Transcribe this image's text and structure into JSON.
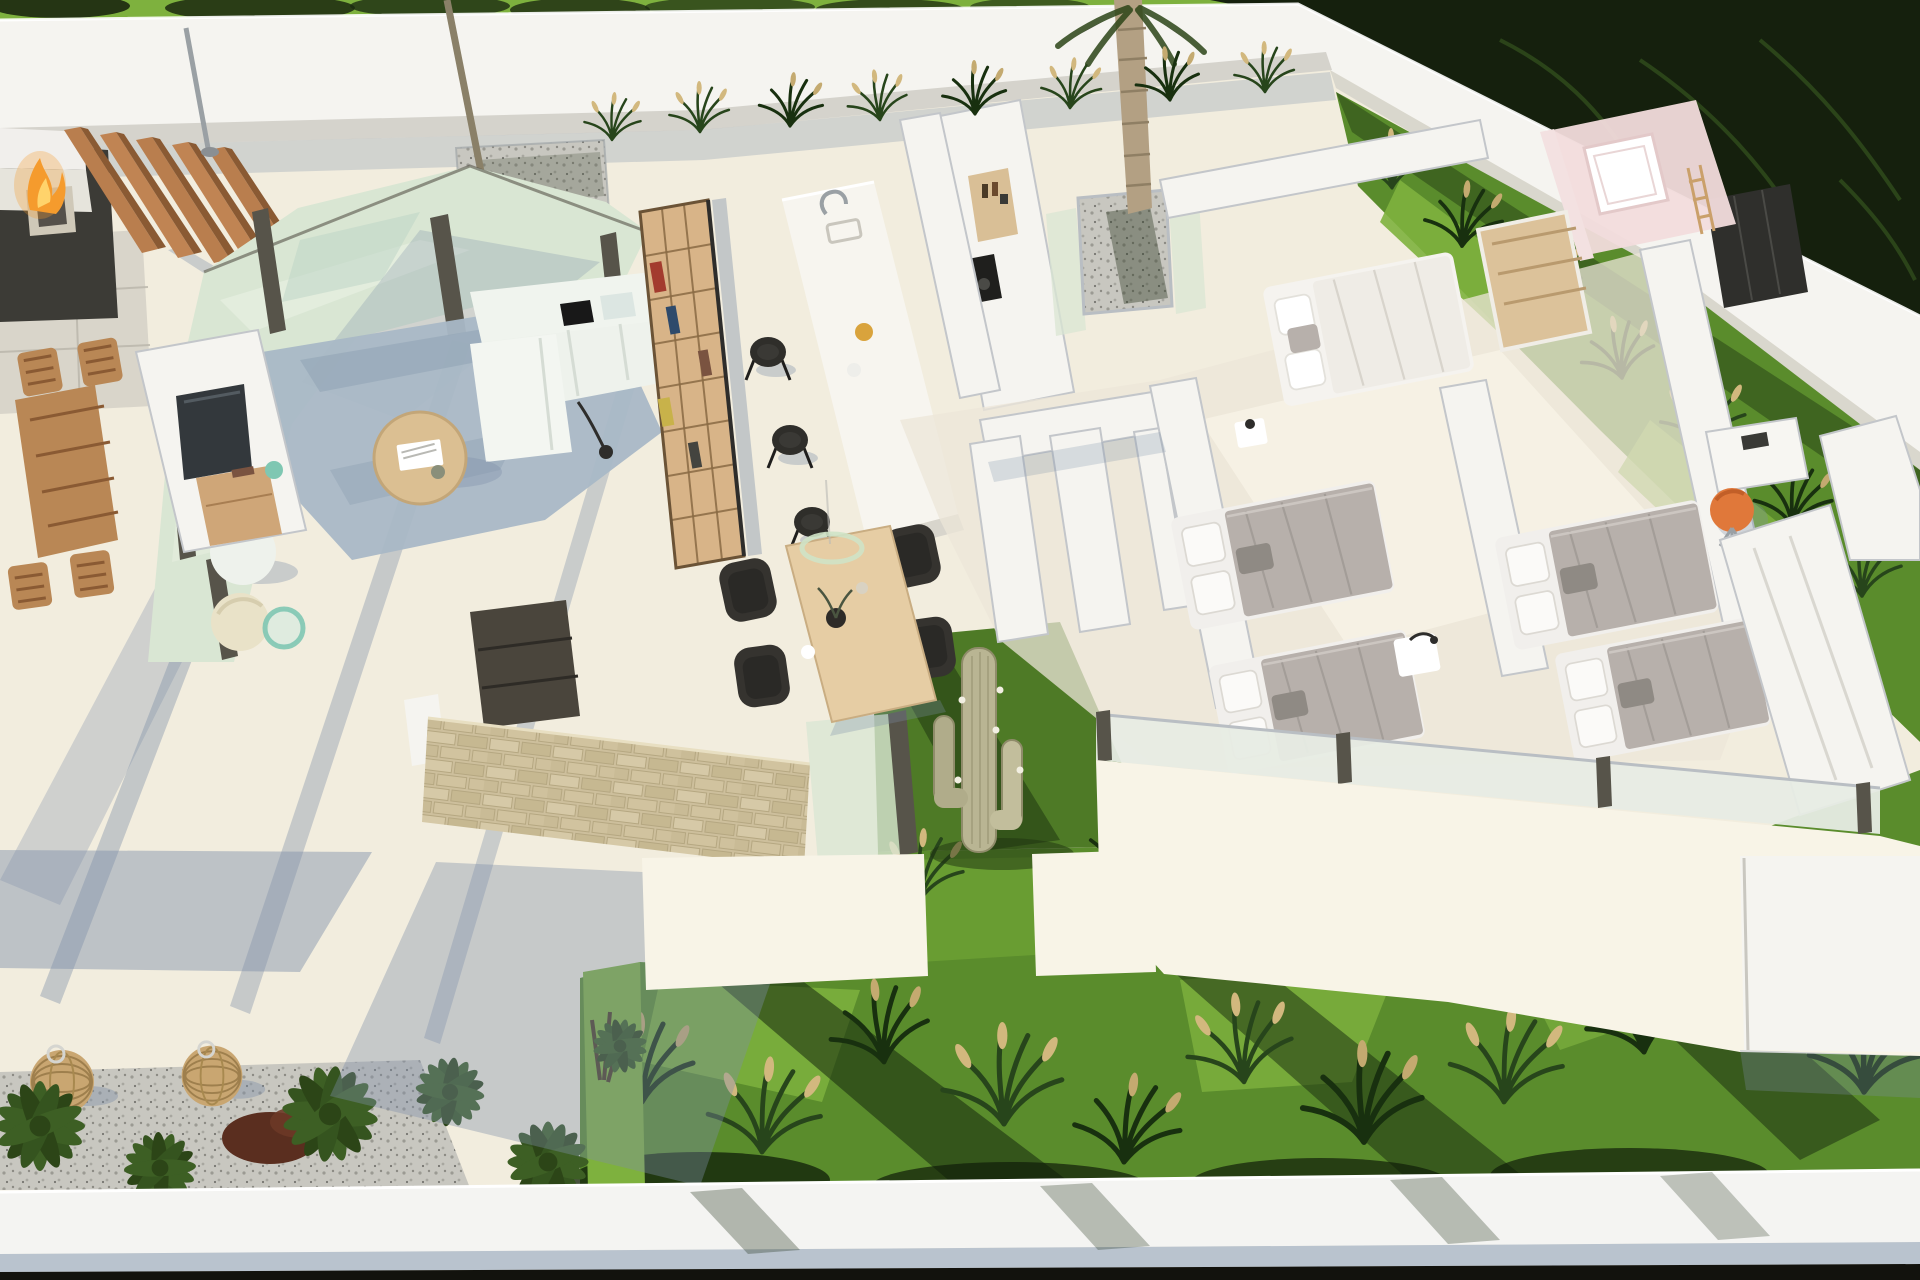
{
  "meta": {
    "title": "Aerial 3D dollhouse render of a modern single-story villa floor plan",
    "view": "top-down cutaway architectural visualization",
    "setting": "white-walled villa with terraces, garden bands and ornamental grasses"
  },
  "palette": {
    "floor": "#f2edde",
    "floor_bright": "#f8f4e7",
    "patio_gray": "#d9d5ca",
    "shadow": "#7d8fa8",
    "wall": "#f5f4f0",
    "wall_shade": "#cfcdc6",
    "wall_cap": "#c3c6ca",
    "glass": "#d9e6d3",
    "glass_light": "#e6efe0",
    "frame": "#57544a",
    "grass_bright": "#7eb13e",
    "grass_mid": "#5a8c2c",
    "grass_dark": "#2c4517",
    "foliage": "#15200d",
    "wood": "#b97e4e",
    "wood_dark": "#8a5a33",
    "wood_light": "#e6cda4",
    "shelf": "#d8b488",
    "stone": "#cdbf9c",
    "gravel": "#c8c7c0",
    "rug": "#a9b8c6",
    "sofa": "#eef2ec",
    "duvet": "#b7b0ab",
    "pillow": "#f1efec",
    "dark": "#33322e",
    "tv": "#33383c",
    "orange": "#e0783a",
    "pink": "#f2dcdc",
    "flame": "#f59b2d",
    "flame_core": "#ffd36b",
    "lantern": "#c9a671",
    "cactus": "#b9b593",
    "trunk": "#b3a083",
    "walkway": "#f4f4f2",
    "walkway_shade": "#b9c3ce",
    "bottom_dark": "#12120d",
    "teal": "#7fc7b2"
  },
  "objects": [
    "perimeter-white-wall",
    "garden-lawn",
    "ornamental-grasses",
    "palm-tree",
    "courtyard-gravel",
    "wood-slat-pergola",
    "fire-pit",
    "sunken-lounge",
    "outdoor-dining-set",
    "wicker-lanterns",
    "glass-terrace",
    "sliding-door-frames",
    "living-rug",
    "sectional-sofa",
    "round-coffee-table",
    "bookshelf",
    "tv-panel",
    "sideboard",
    "stone-feature-wall",
    "media-unit",
    "kitchen-island",
    "bar-stools",
    "faucet",
    "cooktop",
    "pantry-niche",
    "dining-table",
    "dining-chairs",
    "pendant-ring-light",
    "cactus-patio",
    "cactus",
    "master-bed",
    "twin-beds",
    "nightstands",
    "wardrobes",
    "pink-bathroom",
    "bathtub",
    "desk",
    "orange-chair",
    "glass-balustrade",
    "white-walkway",
    "fern-plants"
  ]
}
